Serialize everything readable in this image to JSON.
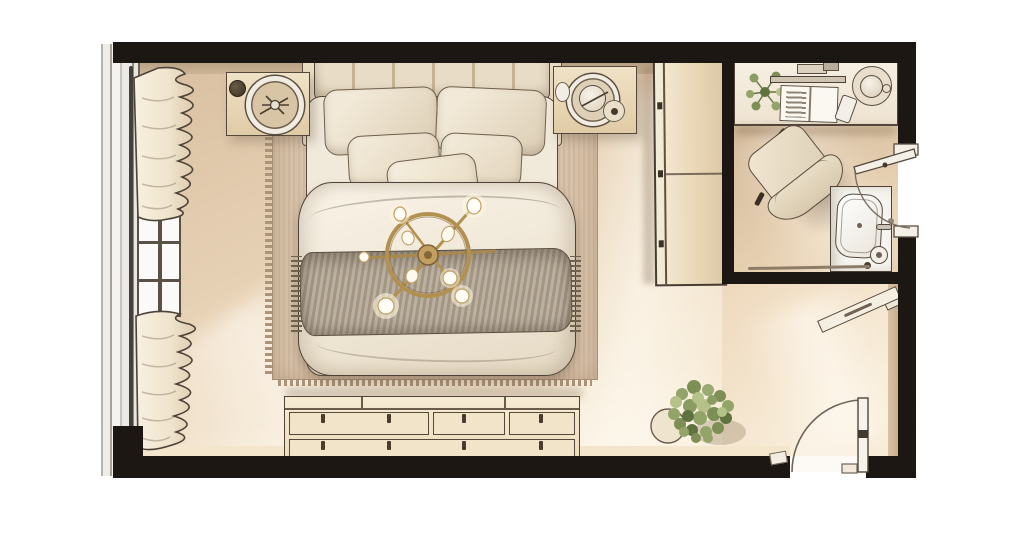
{
  "meta": {
    "kind": "floor-plan-top-view-render",
    "visible_text": "none"
  },
  "scene": {
    "rooms": [
      {
        "name": "bedroom",
        "items": [
          "window-wall",
          "curtain-top",
          "curtain-bottom",
          "window-panes",
          "nightstand-left",
          "nightstand-right",
          "bed",
          "headboard",
          "pillow-back-left",
          "pillow-back-right",
          "pillow-mid-left",
          "pillow-mid-right",
          "pillow-accent",
          "duvet",
          "throw-blanket",
          "ceiling-light-chandelier",
          "area-rug",
          "wardrobe",
          "dresser",
          "floor-plant",
          "entry-door",
          "wall-shelf"
        ]
      },
      {
        "name": "ensuite-study",
        "items": [
          "desk",
          "desk-plant",
          "monitor-bar",
          "magazine",
          "phone",
          "desk-tray",
          "armchair",
          "sink-vanity",
          "faucet",
          "paper-roll",
          "ensuite-door",
          "floor-track"
        ]
      }
    ],
    "icons": [
      "plant-icon",
      "door-arc-icon",
      "light-bulb-icon"
    ]
  },
  "colors": {
    "wall": "#1c1713",
    "outline": "#54483a",
    "floorA": "#d9bfa2",
    "floorB": "#f6e8d2",
    "floorExtA": "#eed9bd",
    "floorExtB": "#f8ecd8",
    "floorOffA": "#c9ac8c",
    "floorOffB": "#e8d2b4",
    "rug": "#d7c1a8",
    "rugBorder": "#a78f74",
    "wood": "#f0e2c6",
    "woodDeep": "#e0cba6",
    "fabric": "#ecdfc9",
    "fabricDeep": "#d9c8ab",
    "duvet": "#f7f1e5",
    "throw": "#b1a492",
    "gold": "#b2904f",
    "goldDeep": "#84673a",
    "green": "#8b9c63",
    "greenDark": "#5f7240",
    "greenLight": "#b4c289",
    "faceDark": "#c2aa8c",
    "faceLight": "#f4e5cd",
    "glassA": "#efede9",
    "glassB": "#b7b2ab"
  }
}
